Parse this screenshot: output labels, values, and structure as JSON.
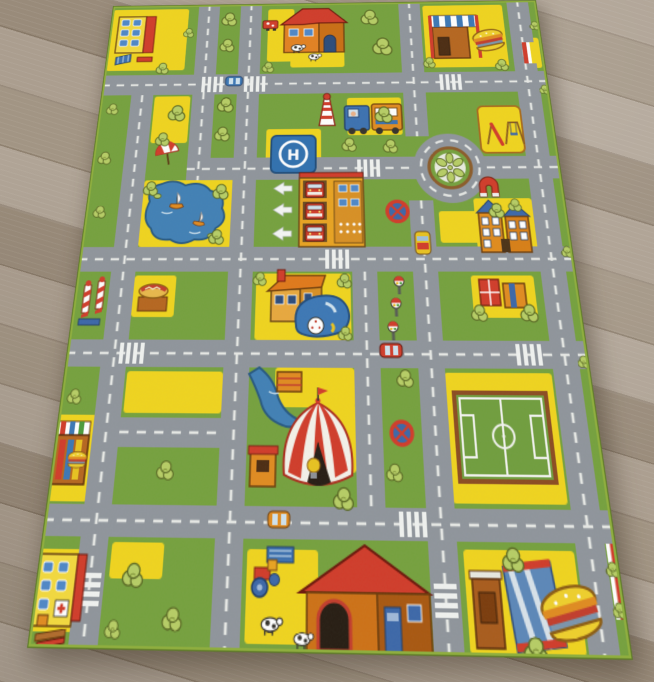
{
  "scene": {
    "type": "photograph",
    "description": "Children's city-traffic play rug lying on a light oak laminate floor, viewed at a slight angle",
    "floor": "grey-beige wooden laminate planks, diagonal grain",
    "rug_style": "green city road play mat with yellow blocks and grey roads"
  },
  "palette": {
    "grass": "#74a03c",
    "road": "#8e949b",
    "dash": "#eef0ec",
    "yellow": "#f0d41c",
    "red": "#d03a28",
    "orange": "#e08a1e",
    "blue": "#3a76b5",
    "navy": "#1d3a66",
    "tree": "#b6cd64",
    "treeline": "#55641f",
    "white": "#f2f3ef",
    "brown": "#a85a1a",
    "binding": "#8fae3f"
  },
  "rug": {
    "helipad_letter": "H",
    "landmarks": [
      "apartment-block-top-left",
      "farmhouse-with-cows-top",
      "burger-restaurant-top-right",
      "tram",
      "lighthouse",
      "helipad",
      "fire-station-with-trucks",
      "exit-arrows",
      "roundabout-flower",
      "playground",
      "magnet-gate",
      "school",
      "lake-with-sailboats",
      "beach-parasol",
      "barber-poles",
      "hotdog-stand",
      "house-with-blue-car",
      "traffic-lights",
      "no-stopping-signs",
      "circus-tent",
      "river",
      "balloon-cart",
      "soccer-field",
      "burger-kiosk-left",
      "hospital",
      "farm-with-tractor-and-cows",
      "burger-restaurant-bottom-right",
      "edge-stripes",
      "trees",
      "zebra-crossings"
    ],
    "road_features": [
      "dashed centre lines",
      "zebra crossings",
      "roundabout",
      "traffic lights",
      "no-stopping signs"
    ]
  }
}
